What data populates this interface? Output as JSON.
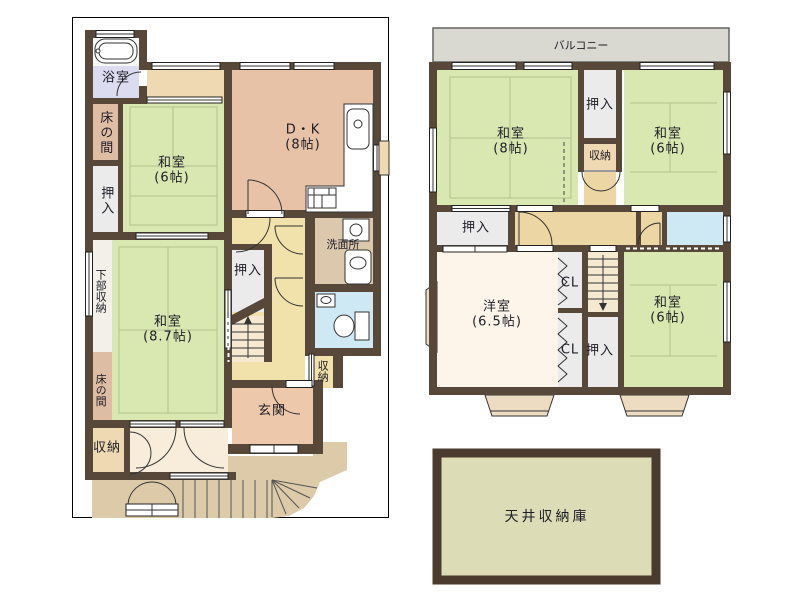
{
  "palette": {
    "wall": "#57483a",
    "tatami": "#d9e7b0",
    "dk_salmon": "#e8c2a6",
    "hall_yellow": "#f1e1aa",
    "hall2_tan": "#ecd6a4",
    "bath_lavender": "#dcdcf0",
    "toilet_blue": "#cfe9f4",
    "closet_gray": "#ebebeb",
    "tokonoma_pink": "#dfbca4",
    "porch_tan": "#dccaa9",
    "balcony_gray": "#d9d9d1",
    "attic_beige": "#dcdcb6",
    "bay_tan": "#eddcc2"
  },
  "floor1": {
    "bath": {
      "label": "浴室"
    },
    "tokonoma_upper": {
      "label": "床の間"
    },
    "washitsu6": {
      "name": "和室",
      "size": "(6帖)"
    },
    "oshiire_upper": {
      "label": "押入"
    },
    "dk": {
      "name": "D・K",
      "size": "(8帖)"
    },
    "senmenjo": {
      "label": "洗面所"
    },
    "lower_storage": {
      "label": "下部収納"
    },
    "oshiire_mid": {
      "label": "押入"
    },
    "washitsu87": {
      "name": "和室",
      "size": "(8.7帖)"
    },
    "tokonoma_lower": {
      "label": "床の間"
    },
    "storage_sw": {
      "label": "収納"
    },
    "genkan": {
      "label": "玄関"
    },
    "storage_e": {
      "label": "収納"
    }
  },
  "floor2": {
    "balcony": {
      "label": "バルコニー"
    },
    "washitsu8": {
      "name": "和室",
      "size": "(8帖)"
    },
    "oshiire_n": {
      "label": "押入"
    },
    "storage_c": {
      "label": "収納"
    },
    "washitsu6_ne": {
      "name": "和室",
      "size": "(6帖)"
    },
    "oshiire_w": {
      "label": "押入"
    },
    "youshitsu": {
      "name": "洋室",
      "size": "(6.5帖)"
    },
    "cl_upper": {
      "label": "CL"
    },
    "cl_lower": {
      "label": "CL"
    },
    "oshiire_s": {
      "label": "押入"
    },
    "washitsu6_se": {
      "name": "和室",
      "size": "(6帖)"
    }
  },
  "attic": {
    "label": "天井収納庫"
  }
}
